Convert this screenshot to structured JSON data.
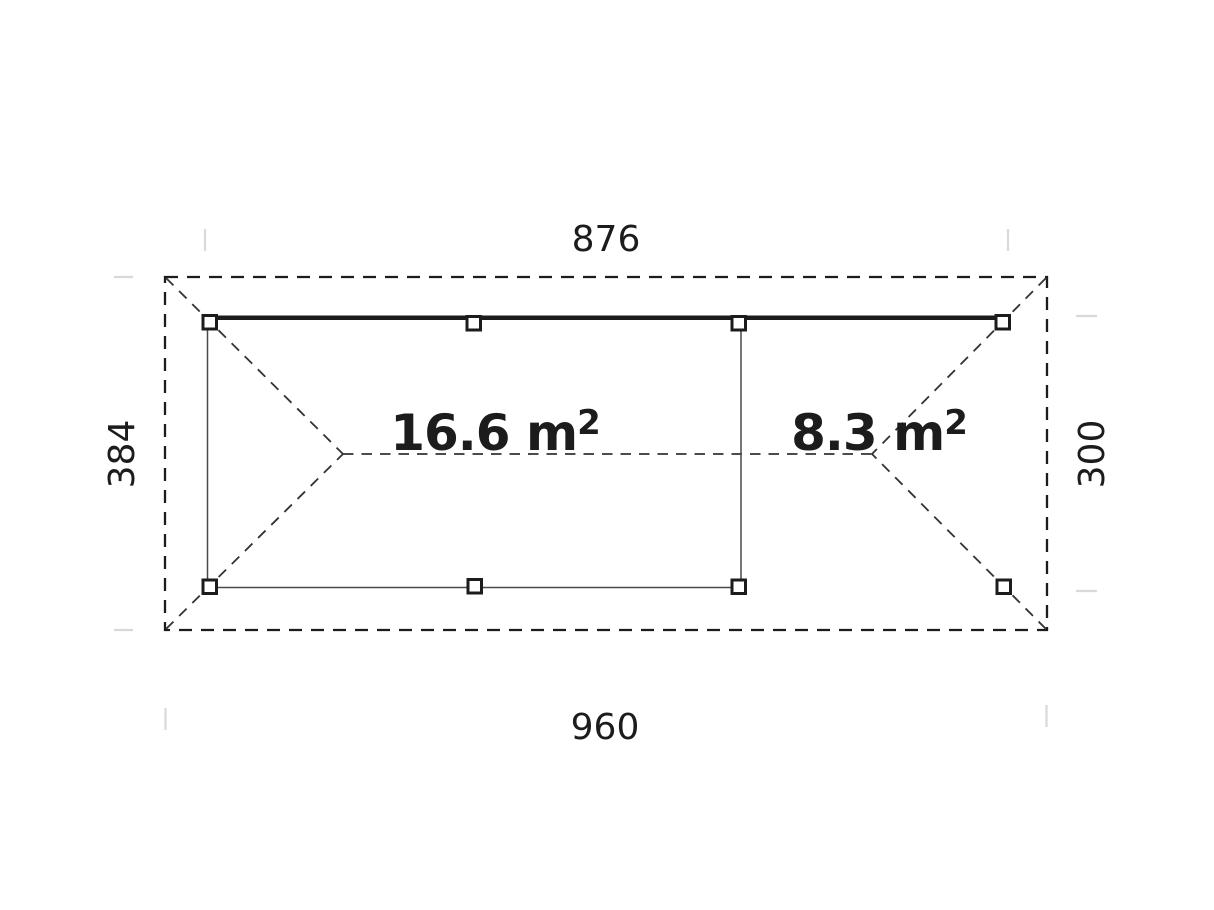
{
  "colors": {
    "ink": "#1c1c1c",
    "line": "#333333",
    "thin": "#4a4a4a",
    "tick": "#d9d9d9",
    "paper": "#ffffff"
  },
  "plan": {
    "type": "gazebo-carport floor plan, hip roof overhang shown dashed",
    "dimensions": {
      "top": "876",
      "bottom": "960",
      "left": "384",
      "right": "300"
    },
    "areas": [
      {
        "value": "16.6 m",
        "sup": "2"
      },
      {
        "value": "8.3 m",
        "sup": "2"
      }
    ]
  }
}
